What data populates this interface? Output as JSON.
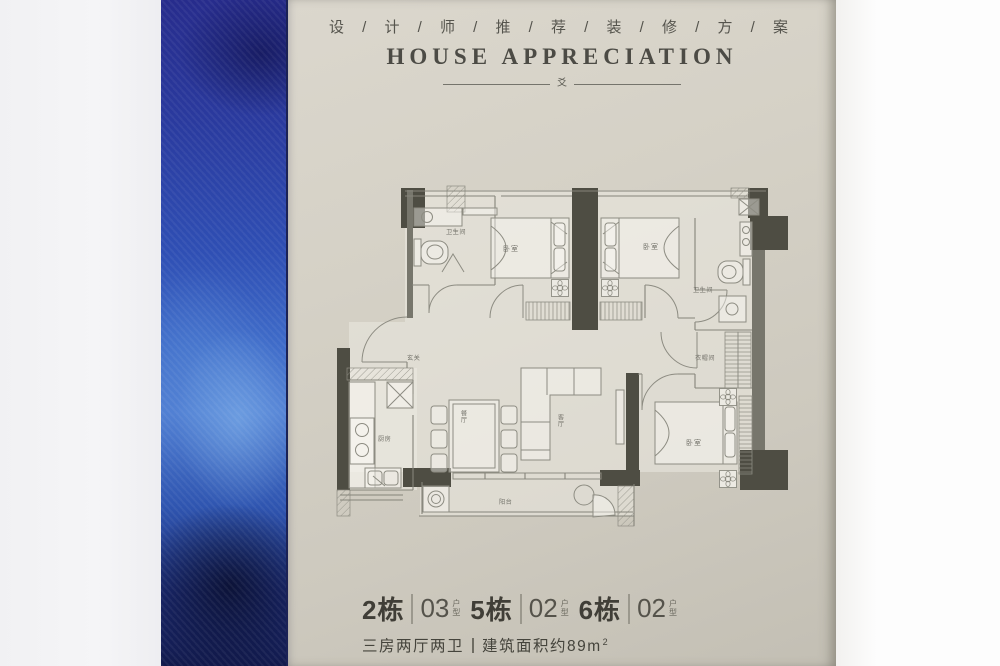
{
  "header": {
    "cn_title": "设 / 计 / 师 / 推 / 荐 / 装 / 修 / 方 / 案",
    "en_title": "HOUSE APPRECIATION",
    "ornament": "爻"
  },
  "floorplan": {
    "rooms": {
      "bath1": "卫生间",
      "bedroom1": "卧室",
      "bedroom2": "卧室",
      "bath2": "卫生间",
      "closet": "衣帽间",
      "foyer": "玄关",
      "kitchen": "厨房",
      "dining": "餐厅",
      "living": "客厅",
      "master": "卧室",
      "balcony": "阳台"
    }
  },
  "footer": {
    "units": [
      {
        "building": "2栋",
        "number": "03",
        "label": "户型"
      },
      {
        "building": "5栋",
        "number": "02",
        "label": "户型"
      },
      {
        "building": "6栋",
        "number": "02",
        "label": "户型"
      }
    ],
    "layout": "三房两厅两卫",
    "area": "建筑面积约89m",
    "area_sup": "2"
  },
  "palette": {
    "poster": "#d3cfc4",
    "blue-deep": "#1a2266",
    "blue-mid": "#2e4cb2",
    "blue-light": "#5b87d8",
    "wall-dark": "#4e4d43",
    "wall-mid": "#77766c",
    "line": "#85847a",
    "ink": "#45443c",
    "label": "#74736b"
  }
}
